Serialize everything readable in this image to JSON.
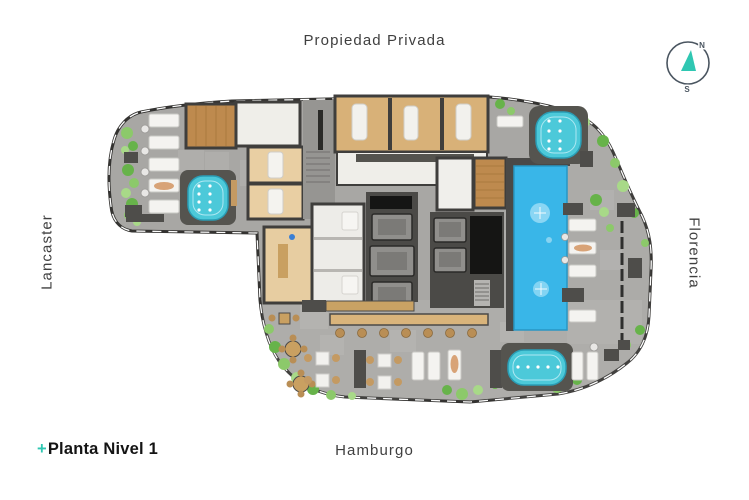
{
  "street_labels": {
    "top": "Propiedad Privada",
    "left": "Lancaster",
    "right": "Florencia",
    "bottom": "Hamburgo"
  },
  "title_block": {
    "plus": "+",
    "text": "Planta Nivel 1"
  },
  "compass": {
    "north": "N",
    "south": "S"
  },
  "colors": {
    "accent_teal": "#2fc7b2",
    "pool_water": "#39b6e8",
    "jacuzzi_water": "#4cc9d9",
    "floor_stone": "#a8a7a4",
    "wall_dark": "#3f3e3c",
    "wood_light": "#d8b178",
    "wood_sauna": "#be8a4e",
    "white_room": "#efeee9",
    "plant_green": "#7cc45c",
    "label_gray": "#3f3f3f",
    "compass_ring": "#4a5560"
  }
}
